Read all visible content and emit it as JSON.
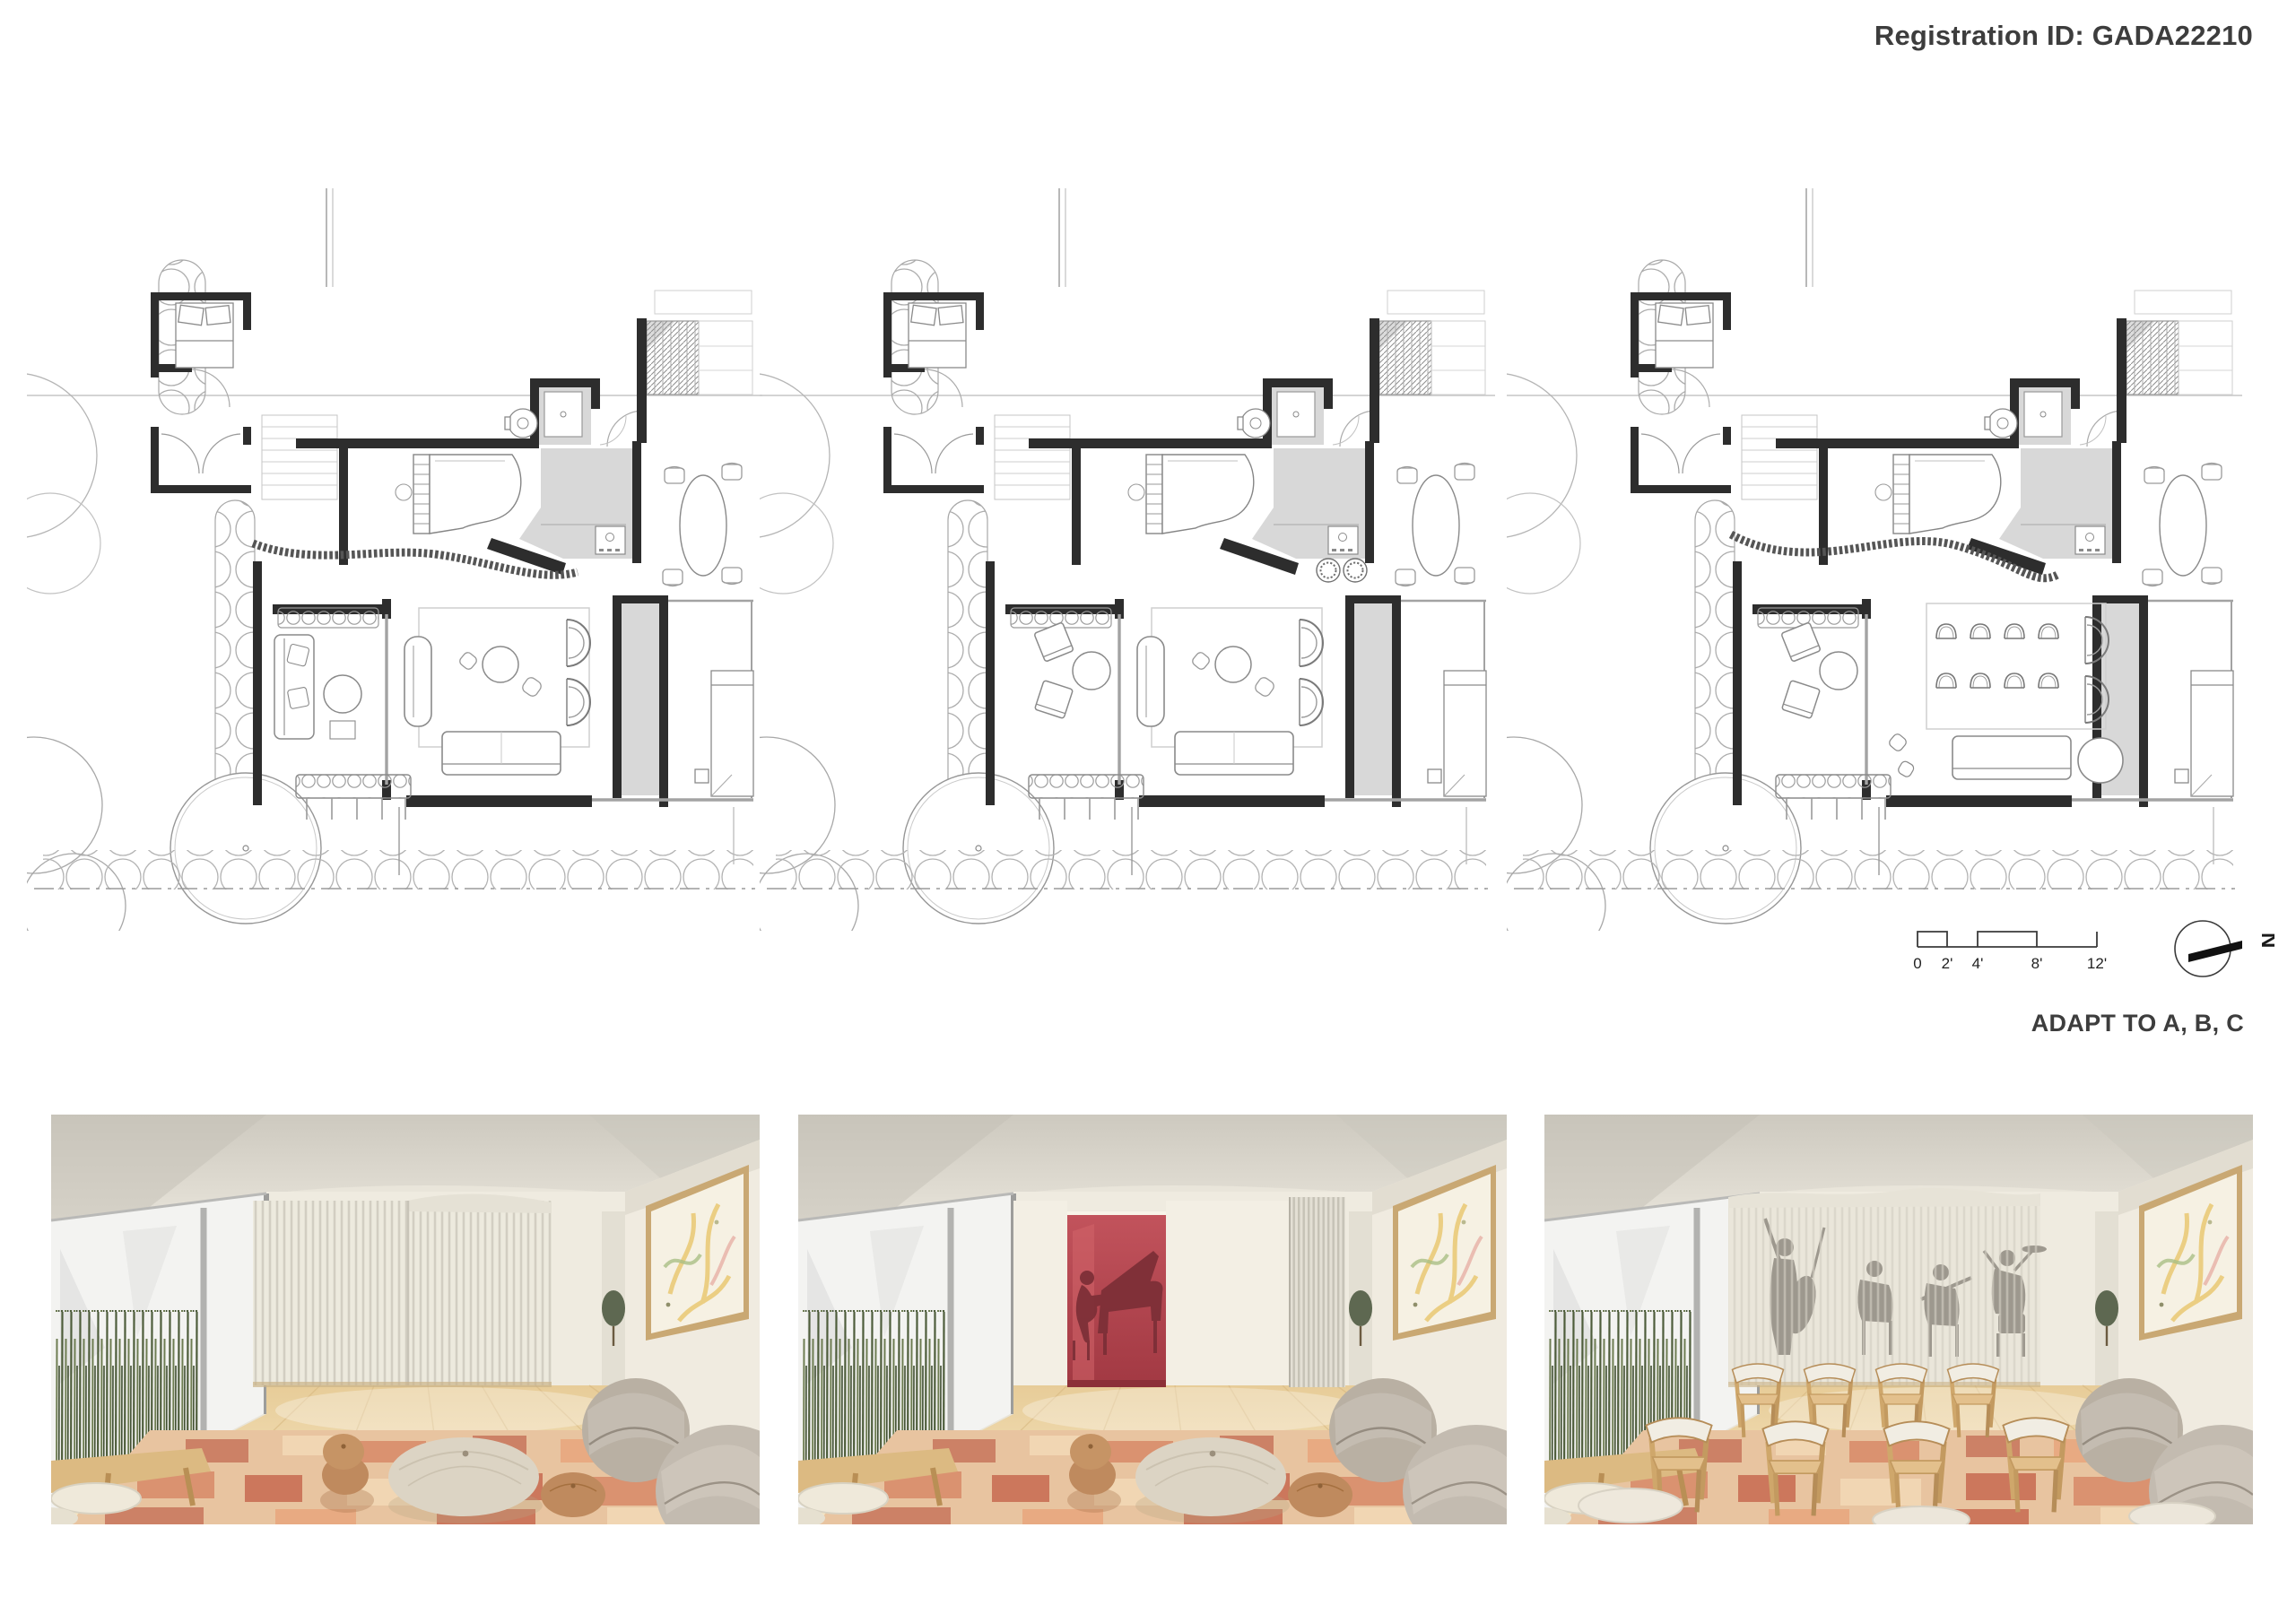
{
  "sheet": {
    "registration_label": "Registration ID: GADA22210",
    "caption": "ADAPT TO A, B, C",
    "background": "#ffffff"
  },
  "scale_bar": {
    "tick_labels": [
      "0",
      "2'",
      "4'",
      "8'",
      "12'"
    ]
  },
  "compass": {
    "label": "N"
  },
  "plans": [
    {
      "id": "A",
      "name": "floor-plan-a",
      "scheme": "lounge with sofa seating"
    },
    {
      "id": "B",
      "name": "floor-plan-b",
      "scheme": "salon with paired chairs"
    },
    {
      "id": "C",
      "name": "floor-plan-c",
      "scheme": "recital rows of chairs"
    }
  ],
  "renders": [
    {
      "id": "A",
      "name": "render-lounge-divider-closed"
    },
    {
      "id": "B",
      "name": "render-piano-alcove-open"
    },
    {
      "id": "C",
      "name": "render-concert-audience-rows"
    }
  ],
  "colors": {
    "wall_ink": "#2d2d2d",
    "plan_gray": "#d8d8d8",
    "site_line": "#a8a8a8",
    "accent_red": "#b14049",
    "silhouette_red": "#7d2f37",
    "silhouette_gray": "#8b857c",
    "rug_base": "#e8c4a0",
    "rug_dark": "#c97a60",
    "rug_light": "#f2d8b6",
    "wood_floor": "#ecd4a0",
    "curtain": "#eae6da",
    "armchair_gray": "#b9b0a3",
    "pouf_tan": "#bf8a5e",
    "text": "#3d3d3d"
  }
}
